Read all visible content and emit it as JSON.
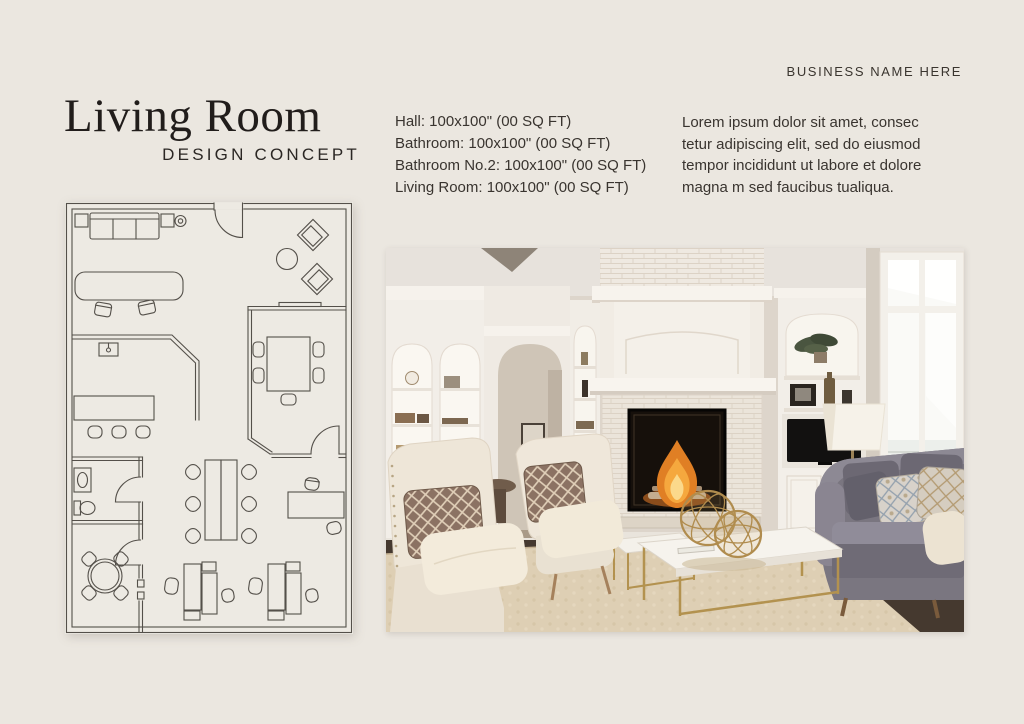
{
  "business_name": "BUSINESS NAME HERE",
  "title": "Living Room",
  "subtitle": "DESIGN CONCEPT",
  "measurements": [
    "Hall: 100x100\" (00 SQ FT)",
    "Bathroom: 100x100\" (00 SQ FT)",
    "Bathroom No.2: 100x100\" (00 SQ FT)",
    "Living Room: 100x100\" (00 SQ FT)"
  ],
  "description_lines": [
    "Lorem ipsum dolor sit amet, consec",
    "tetur adipiscing elit, sed do eiusmod",
    "tempor incididunt ut labore et dolore",
    "magna m sed faucibus tualiqua."
  ],
  "floor_plan": {
    "name": "office-floor-plan-drawing",
    "line_color": "#54504a"
  },
  "photo": {
    "name": "living-room-photo",
    "contents": "white fireplace with fire, built-in shelves, TV, gray sofa, two cream armchairs, marble coffee table with gold spheres, tall window"
  },
  "colors": {
    "page_background": "#ebe7e0",
    "title_ink": "#211d1b",
    "body_text": "#39342f",
    "plan_line": "#54504a",
    "flame_orange": "#e07f24",
    "sofa_gray": "#7a7680",
    "rug_cream": "#decfb4",
    "gold_accent": "#b3924f"
  }
}
